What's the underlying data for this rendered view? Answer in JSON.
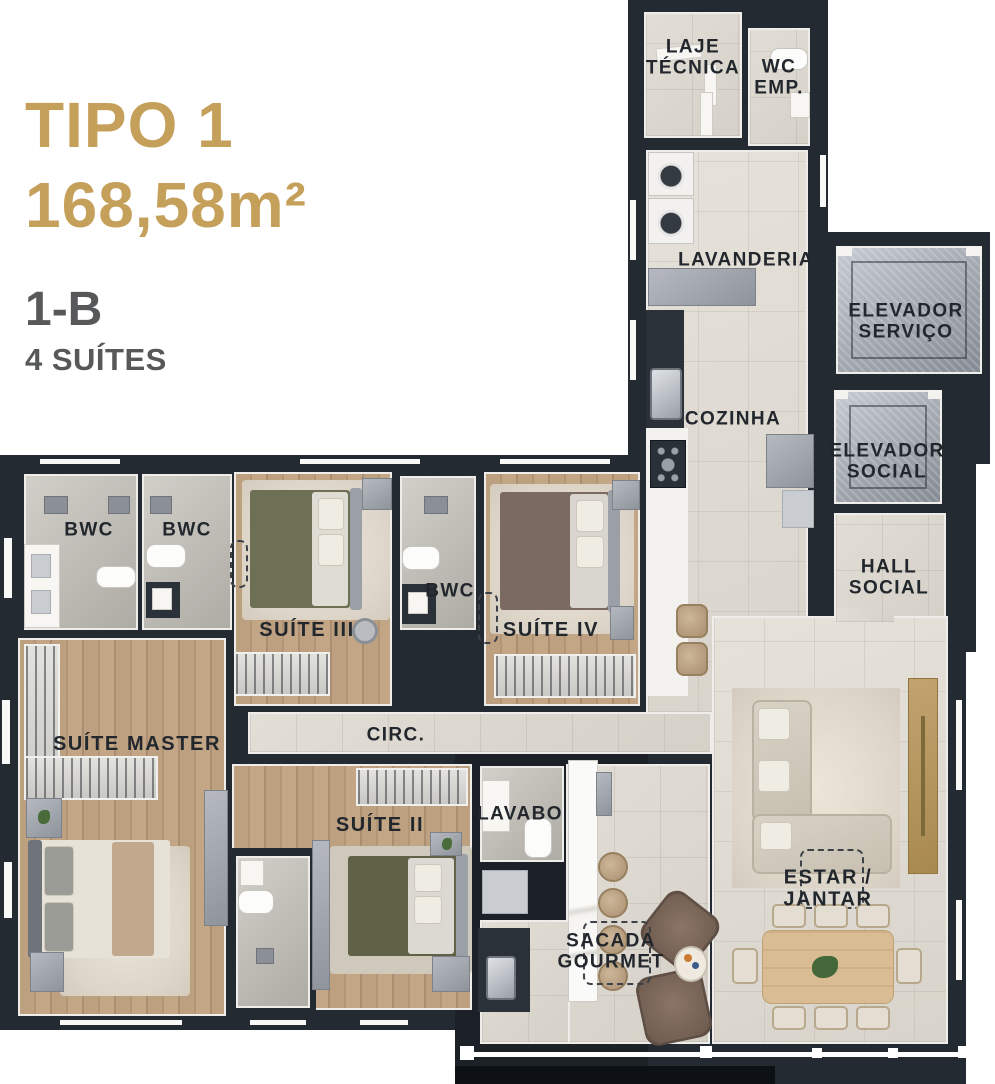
{
  "title": {
    "line1": "TIPO 1",
    "line2": "168,58m²",
    "variant": "1-B",
    "subtitle": "4 SUÍTES"
  },
  "rooms": {
    "laje": {
      "label": "LAJE\nTÉCNICA"
    },
    "wc_emp": {
      "label": "WC\nEMP."
    },
    "lavanderia": {
      "label": "LAVANDERIA"
    },
    "cozinha": {
      "label": "COZINHA"
    },
    "elev_servico": {
      "label": "ELEVADOR\nSERVIÇO"
    },
    "elev_social": {
      "label": "ELEVADOR\nSOCIAL"
    },
    "hall_social": {
      "label": "HALL\nSOCIAL"
    },
    "bwc1": {
      "label": "BWC"
    },
    "bwc2": {
      "label": "BWC"
    },
    "bwc3": {
      "label": "BWC"
    },
    "bwc4": {
      "label": "BWC"
    },
    "suite3": {
      "label": "SUÍTE III"
    },
    "suite4": {
      "label": "SUÍTE IV"
    },
    "suite_master": {
      "label": "SUÍTE MASTER"
    },
    "suite2": {
      "label": "SUÍTE II"
    },
    "circ": {
      "label": "CIRC."
    },
    "lavabo": {
      "label": "LAVABO"
    },
    "sacada": {
      "label": "SACADA\nGOURMET"
    },
    "estar": {
      "label": "ESTAR / JANTAR"
    }
  },
  "colors": {
    "accent_gold": "#C5A05A",
    "wall": "#232a31",
    "floor_tile": "#dbd7cf",
    "floor_wood": "#b99c7c",
    "elevator_metal": "#9aa0a9",
    "label_text": "#22272d"
  }
}
